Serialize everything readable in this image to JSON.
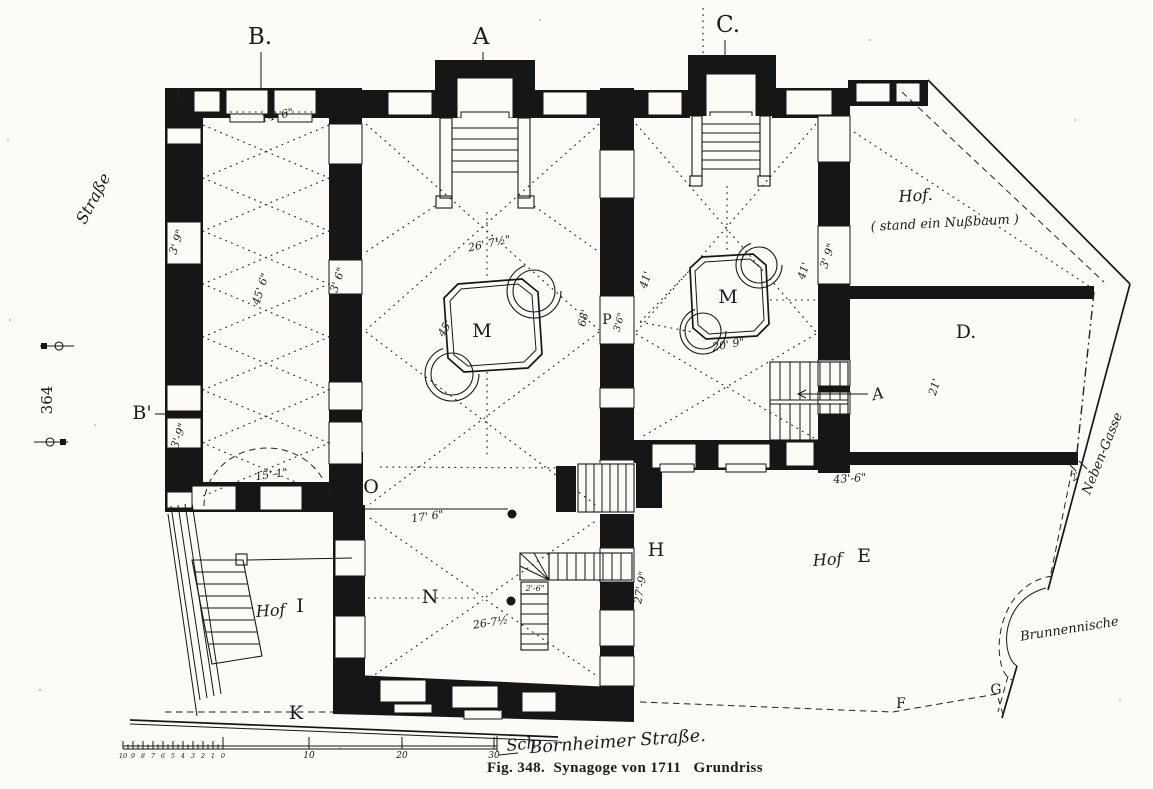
{
  "document": {
    "caption": "Fig. 348.  Synagoge von 1711   Grundriss",
    "page_number": "364"
  },
  "scale_bar": {
    "minor_numbers": [
      "10",
      "9",
      "8",
      "7",
      "6",
      "5",
      "4",
      "3",
      "2",
      "1",
      "0"
    ],
    "major_numbers": [
      "10",
      "20",
      "30"
    ],
    "major_x": [
      309,
      402,
      494
    ],
    "unit_label": "Sch"
  },
  "plan": {
    "ink_color": "#161616",
    "paper_color": "#fcfbf7",
    "labels": [
      {
        "id": "section-marker-b",
        "t": "B.",
        "x": 260,
        "y": 44,
        "r": 0,
        "c": "marker-lg"
      },
      {
        "id": "section-marker-a",
        "t": "A",
        "x": 481,
        "y": 44,
        "r": 0,
        "c": "marker-lg"
      },
      {
        "id": "section-marker-c",
        "t": "C.",
        "x": 728,
        "y": 32,
        "r": 0,
        "c": "marker-lg"
      },
      {
        "id": "section-marker-b-prime",
        "t": "B'",
        "x": 142,
        "y": 419,
        "r": 0,
        "c": "marker"
      },
      {
        "id": "marker-l",
        "t": "L",
        "x": 180,
        "y": 99,
        "r": 0,
        "c": "marker-sm"
      },
      {
        "id": "marker-o",
        "t": "O",
        "x": 371,
        "y": 493,
        "r": 0,
        "c": "marker"
      },
      {
        "id": "marker-n",
        "t": "N",
        "x": 430,
        "y": 603,
        "r": 0,
        "c": "marker"
      },
      {
        "id": "marker-h",
        "t": "H",
        "x": 656,
        "y": 556,
        "r": 0,
        "c": "marker"
      },
      {
        "id": "marker-k",
        "t": "K",
        "x": 296,
        "y": 719,
        "r": 0,
        "c": "marker"
      },
      {
        "id": "marker-f",
        "t": "F",
        "x": 901,
        "y": 708,
        "r": 0,
        "c": "marker-sm"
      },
      {
        "id": "marker-g",
        "t": "G",
        "x": 996,
        "y": 694,
        "r": 0,
        "c": "marker-sm"
      },
      {
        "id": "room-d",
        "t": "D.",
        "x": 966,
        "y": 338,
        "r": 0,
        "c": "marker"
      },
      {
        "id": "bimah-m-main",
        "t": "M",
        "x": 482,
        "y": 337,
        "r": 0,
        "c": "marker"
      },
      {
        "id": "bimah-m-women",
        "t": "M",
        "x": 728,
        "y": 303,
        "r": 0,
        "c": "marker"
      },
      {
        "id": "door-p",
        "t": "P",
        "x": 607,
        "y": 324,
        "r": 0,
        "c": "marker-sm"
      },
      {
        "id": "stair-a-script",
        "t": "A",
        "x": 879,
        "y": 399,
        "r": -12,
        "c": "script"
      },
      {
        "id": "dim-14-6",
        "t": "14' 6\"",
        "x": 278,
        "y": 119,
        "r": -12,
        "c": "dim"
      },
      {
        "id": "dim-45-6",
        "t": "45' 6\"",
        "x": 264,
        "y": 290,
        "r": -72,
        "c": "dim"
      },
      {
        "id": "dim-3-9-upper",
        "t": "3' 9\"",
        "x": 180,
        "y": 243,
        "r": -72,
        "c": "dim"
      },
      {
        "id": "dim-3-6-left",
        "t": "3' 6\"",
        "x": 341,
        "y": 281,
        "r": -72,
        "c": "dim"
      },
      {
        "id": "dim-3-9-lower",
        "t": "3'-9\"",
        "x": 182,
        "y": 437,
        "r": -70,
        "c": "dim"
      },
      {
        "id": "dim-15-1",
        "t": "15'-1\"",
        "x": 272,
        "y": 478,
        "r": -8,
        "c": "dim"
      },
      {
        "id": "dim-26-7-main",
        "t": "26' 7½\"",
        "x": 490,
        "y": 247,
        "r": -12,
        "c": "dim"
      },
      {
        "id": "dim-45",
        "t": "45'",
        "x": 448,
        "y": 330,
        "r": -60,
        "c": "dim"
      },
      {
        "id": "dim-68",
        "t": "68'",
        "x": 587,
        "y": 319,
        "r": -76,
        "c": "dim"
      },
      {
        "id": "dim-3-6-p",
        "t": "3'6\"",
        "x": 622,
        "y": 323,
        "r": -74,
        "c": "dim-sm"
      },
      {
        "id": "dim-41-left",
        "t": "41'",
        "x": 649,
        "y": 281,
        "r": -72,
        "c": "dim"
      },
      {
        "id": "dim-41-right",
        "t": "41'",
        "x": 807,
        "y": 272,
        "r": -72,
        "c": "dim"
      },
      {
        "id": "dim-3-9-right",
        "t": "3' 9\"",
        "x": 831,
        "y": 257,
        "r": -72,
        "c": "dim"
      },
      {
        "id": "dim-20-9",
        "t": "20' 9\"",
        "x": 729,
        "y": 348,
        "r": -10,
        "c": "dim"
      },
      {
        "id": "dim-21",
        "t": "21'",
        "x": 938,
        "y": 388,
        "r": -74,
        "c": "dim"
      },
      {
        "id": "dim-2",
        "t": "2'",
        "x": 1077,
        "y": 479,
        "r": -35,
        "c": "dim-sm"
      },
      {
        "id": "dim-43-6",
        "t": "43'-6\"",
        "x": 850,
        "y": 482,
        "r": -4,
        "c": "dim"
      },
      {
        "id": "dim-17-6",
        "t": "17' 6\"",
        "x": 428,
        "y": 520,
        "r": -8,
        "c": "dim"
      },
      {
        "id": "dim-26-7-n",
        "t": "26-7½",
        "x": 491,
        "y": 626,
        "r": -9,
        "c": "dim"
      },
      {
        "id": "dim-2-6",
        "t": "2'-6\"",
        "x": 535,
        "y": 591,
        "r": 0,
        "c": "dim-xs"
      },
      {
        "id": "dim-27-9",
        "t": "27'-9\"",
        "x": 644,
        "y": 588,
        "r": -80,
        "c": "dim"
      },
      {
        "id": "dim-5-6",
        "t": "5'6\"",
        "x": 504,
        "y": 705,
        "r": -80,
        "c": "dim-xs"
      },
      {
        "id": "hof-top-script",
        "t": "Hof.",
        "x": 916,
        "y": 201,
        "r": -4,
        "c": "script"
      },
      {
        "id": "hof-top-note",
        "t": "( stand ein Nußbaum )",
        "x": 945,
        "y": 227,
        "r": -3,
        "c": "script-sm"
      },
      {
        "id": "hof-e-script",
        "t": "Hof",
        "x": 828,
        "y": 565,
        "r": -4,
        "c": "script"
      },
      {
        "id": "hof-e-letter",
        "t": "E",
        "x": 864,
        "y": 562,
        "r": 0,
        "c": "marker"
      },
      {
        "id": "hof-i-script",
        "t": "Hof",
        "x": 271,
        "y": 616,
        "r": -4,
        "c": "script"
      },
      {
        "id": "hof-i-letter",
        "t": "I",
        "x": 300,
        "y": 612,
        "r": 0,
        "c": "marker"
      },
      {
        "id": "brunnennische",
        "t": "Brunnennische",
        "x": 1070,
        "y": 633,
        "r": -9,
        "c": "script-sm"
      },
      {
        "id": "neben-gasse",
        "t": "Neben-Gasse",
        "x": 1106,
        "y": 455,
        "r": -68,
        "c": "script-sm"
      },
      {
        "id": "strasse-left",
        "t": "Straße",
        "x": 98,
        "y": 201,
        "r": -62,
        "c": "script"
      },
      {
        "id": "bornheimer-strasse",
        "t": "Bornheimer Straße.",
        "x": 618,
        "y": 747,
        "r": -4,
        "c": "script-lg"
      }
    ]
  }
}
